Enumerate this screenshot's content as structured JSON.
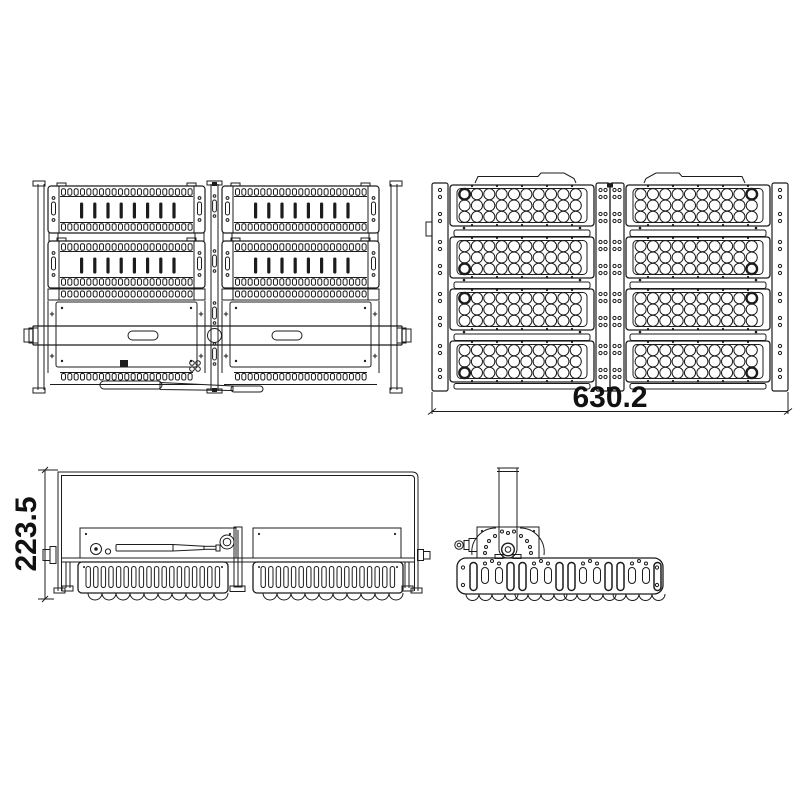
{
  "colors": {
    "line": "#1c1c1c",
    "background": "#ffffff",
    "text": "#111111"
  },
  "dimensions": {
    "front_width": "630.2",
    "side_height": "223.5"
  }
}
